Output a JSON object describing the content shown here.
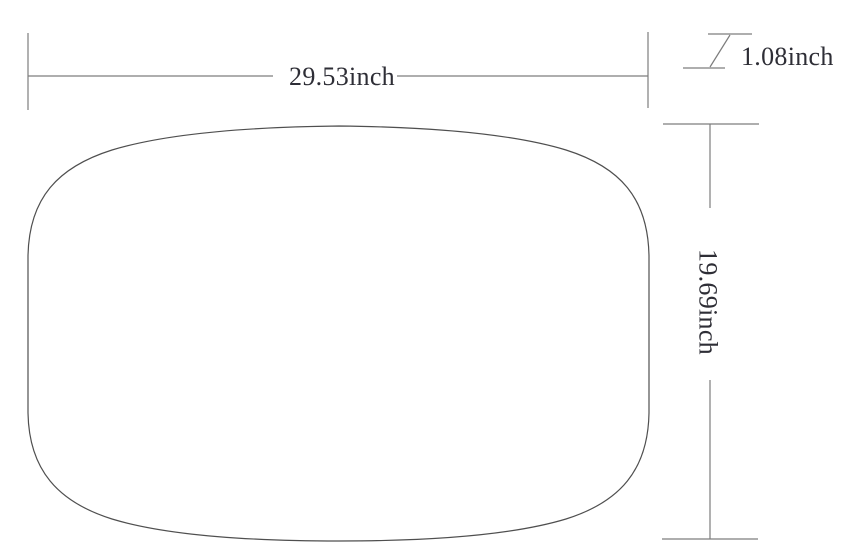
{
  "diagram": {
    "type": "technical-dimension-drawing",
    "shape": "rounded-rectangle-panel-outline",
    "dimensions": {
      "width": {
        "label": "29.53inch",
        "value": 29.53,
        "unit": "inch"
      },
      "height": {
        "label": "19.69inch",
        "value": 19.69,
        "unit": "inch"
      },
      "thickness": {
        "label": "1.08inch",
        "value": 1.08,
        "unit": "inch"
      }
    },
    "colors": {
      "background": "#ffffff",
      "outline": "#4f4f4f",
      "dimension_line": "#7d7d7d",
      "text": "#2e2e36"
    }
  }
}
